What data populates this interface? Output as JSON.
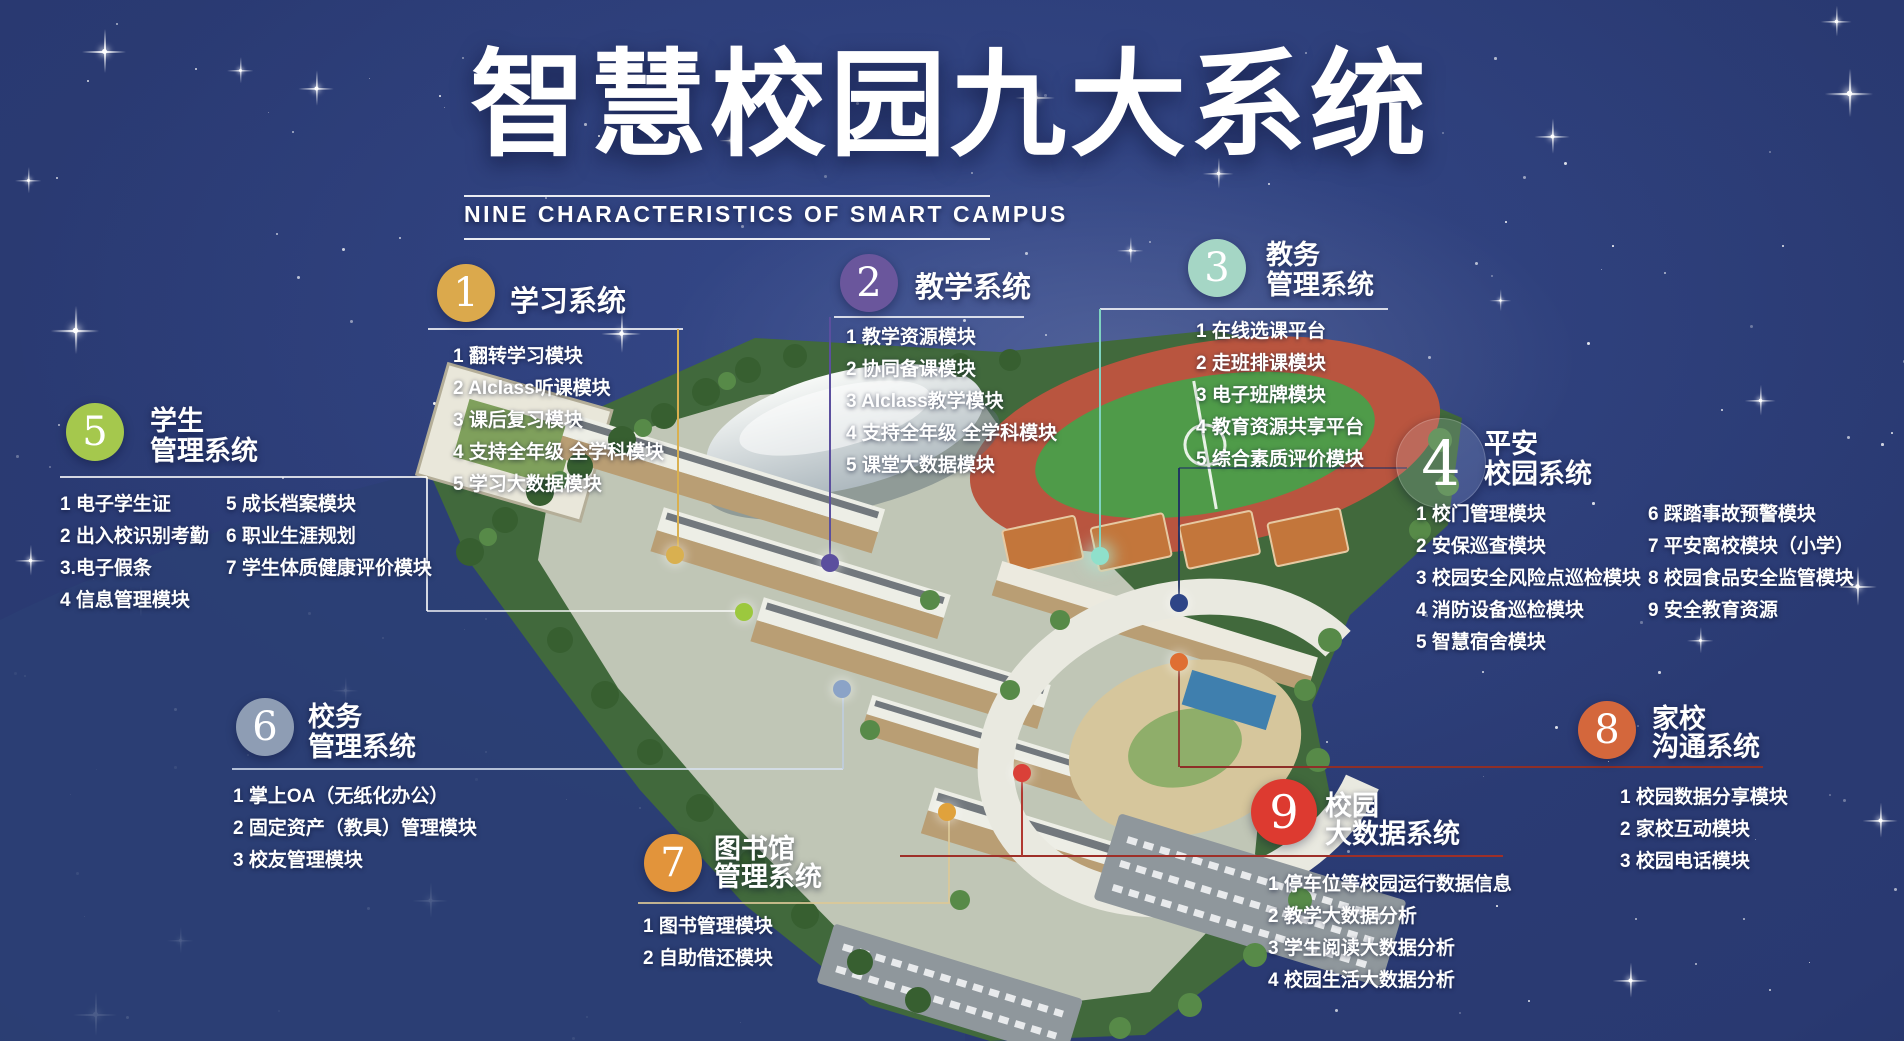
{
  "header": {
    "title": "智慧校园九大系统",
    "subtitle": "NINE CHARACTERISTICS OF SMART CAMPUS"
  },
  "systems": [
    {
      "number": "1",
      "name_lines": [
        "学习系统"
      ],
      "color": "#DBA94C",
      "dot_color": "#D9B050",
      "modules": [
        "1 翻转学习模块",
        "2 AIclass听课模块",
        "3 课后复习模块",
        "4 支持全年级 全学科模块",
        "5 学习大数据模块"
      ]
    },
    {
      "number": "2",
      "name_lines": [
        "教学系统"
      ],
      "color": "#6A569C",
      "dot_color": "#5B4F9E",
      "modules": [
        "1 教学资源模块",
        "2 协同备课模块",
        "3 AIclass教学模块",
        "4 支持全年级 全学科模块",
        "5 课堂大数据模块"
      ]
    },
    {
      "number": "3",
      "name_lines": [
        "教务",
        "管理系统"
      ],
      "color": "#A5D6C5",
      "dot_color": "#8FE0CB",
      "modules": [
        "1 在线选课平台",
        "2 走班排课模块",
        "3 电子班牌模块",
        "4 教育资源共享平台",
        "5 综合素质评价模块"
      ]
    },
    {
      "number": "4",
      "name_lines": [
        "平安",
        "校园系统"
      ],
      "color": "rgba(215,228,255,0.14)",
      "dot_color": "#2E4587",
      "modules_col1": [
        "1 校门管理模块",
        "2 安保巡查模块",
        "3 校园安全风险点巡检模块",
        "4 消防设备巡检模块",
        "5 智慧宿舍模块"
      ],
      "modules_col2": [
        "6 踩踏事故预警模块",
        "7 平安离校模块（小学）",
        "8 校园食品安全监管模块",
        "9 安全教育资源"
      ]
    },
    {
      "number": "5",
      "name_lines": [
        "学生",
        "管理系统"
      ],
      "color": "#A5C84D",
      "dot_color": "#9CC83E",
      "modules_col1": [
        "1 电子学生证",
        "2 出入校识别考勤",
        "3.电子假条",
        "4 信息管理模块"
      ],
      "modules_col2": [
        "5 成长档案模块",
        "6 职业生涯规划",
        "7 学生体质健康评价模块"
      ]
    },
    {
      "number": "6",
      "name_lines": [
        "校务",
        "管理系统"
      ],
      "color": "#8E9DB4",
      "dot_color": "#8BA3C7",
      "modules": [
        "1 掌上OA（无纸化办公）",
        "2 固定资产（教具）管理模块",
        "3 校友管理模块"
      ]
    },
    {
      "number": "7",
      "name_lines": [
        "图书馆",
        "管理系统"
      ],
      "color": "#E2943B",
      "dot_color": "#E0A23C",
      "modules": [
        "1 图书管理模块",
        "2 自助借还模块"
      ]
    },
    {
      "number": "8",
      "name_lines": [
        "家校",
        "沟通系统"
      ],
      "color": "#D4673C",
      "dot_color": "#DF6F33",
      "modules": [
        "1 校园数据分享模块",
        "2 家校互动模块",
        "3 校园电话模块"
      ]
    },
    {
      "number": "9",
      "name_lines": [
        "校园",
        "大数据系统"
      ],
      "color": "#DD3A30",
      "dot_color": "#DA4038",
      "modules": [
        "1 停车位等校园运行数据信息",
        "2 教学大数据分析",
        "3 学生阅读大数据分析",
        "4 校园生活大数据分析"
      ]
    }
  ]
}
